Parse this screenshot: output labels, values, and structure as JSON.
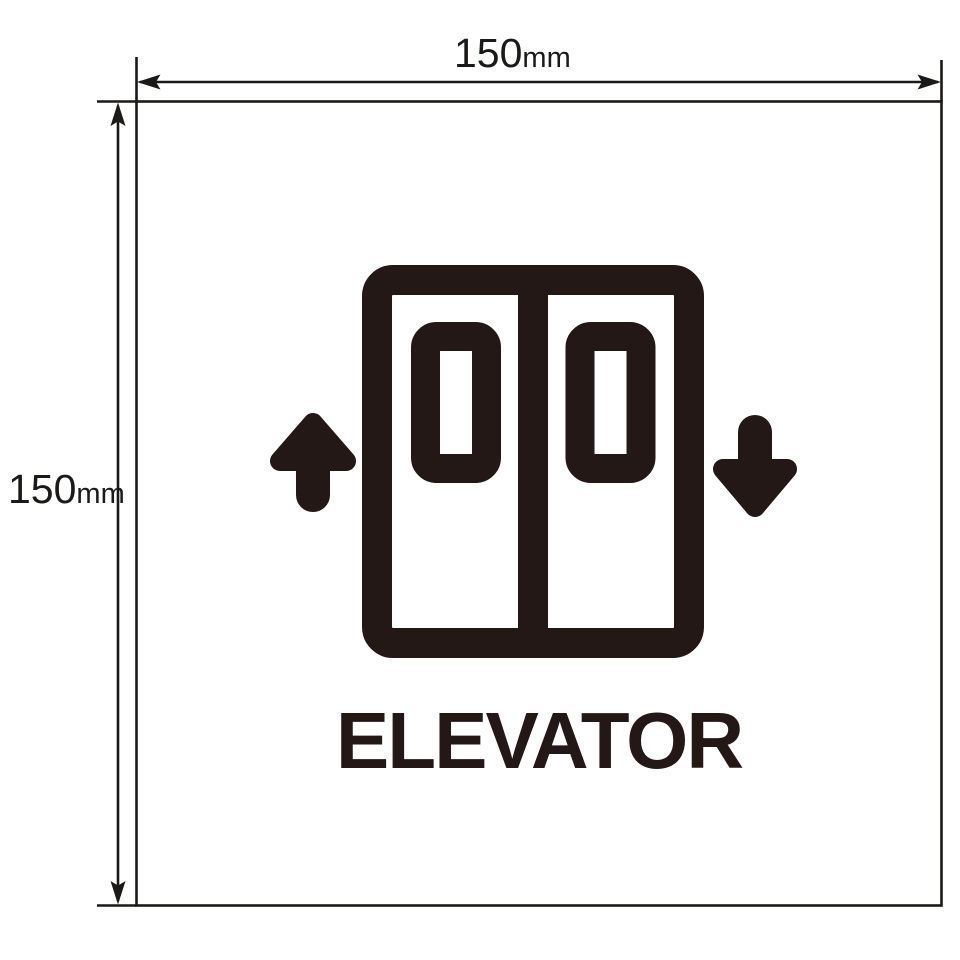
{
  "colors": {
    "ink": "#231815",
    "line": "#1c1a19",
    "background": "#ffffff"
  },
  "annotations": {
    "width": {
      "value": "150",
      "unit": "mm"
    },
    "height": {
      "value": "150",
      "unit": "mm"
    }
  },
  "sign": {
    "title": "ELEVATOR",
    "icon": "elevator-double-doors-with-up-down-arrows-icon"
  }
}
